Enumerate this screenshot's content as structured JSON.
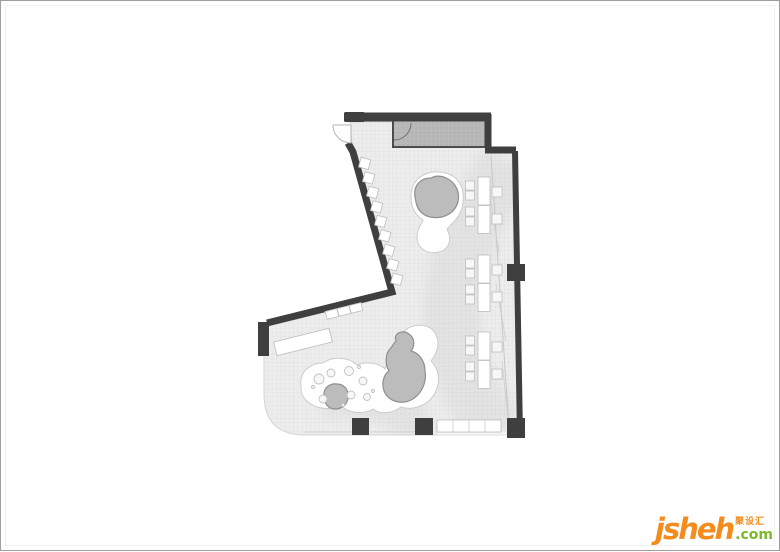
{
  "logo": {
    "brand": "jsheh",
    "tld": ".com",
    "cn": "聚设汇"
  },
  "colors": {
    "page_bg": "#ffffff",
    "frame_border": "#9e9e9e",
    "wall": "#3f3f3f",
    "floor": "#ededed",
    "grid_line": "#dadada",
    "core": "#b5b5b5",
    "tree": "#bcbcbc",
    "tree_edge": "#8f8f8f",
    "shape_edge": "#cccccc",
    "furniture_edge": "#c2c2c2",
    "brand_orange": "#f28c1e",
    "brand_green": "#7cb928"
  },
  "plan": {
    "desk_clusters": 3,
    "desks_per_cluster": 2,
    "wall_stools": 9,
    "columns": 4,
    "tree_islands": 2
  }
}
